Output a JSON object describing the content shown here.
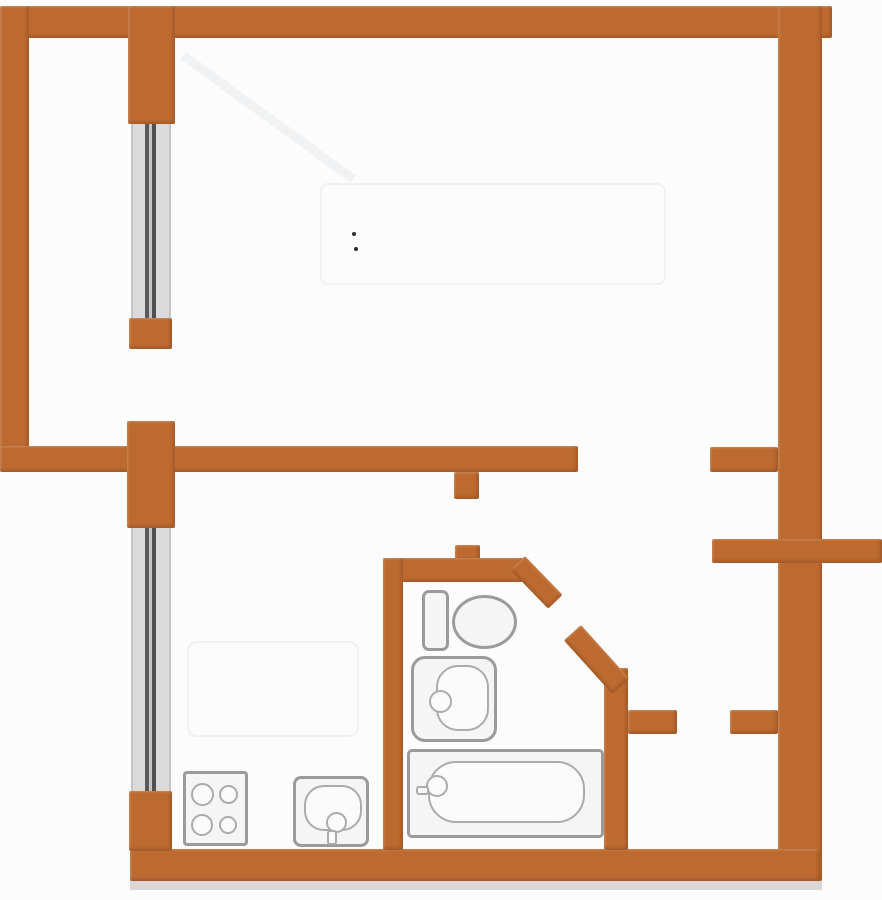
{
  "plan": {
    "name": "one-room-apartment-floor-plan",
    "canvas": {
      "width": 882,
      "height": 900
    }
  },
  "colors": {
    "bg": "#fcfcfc",
    "wall": "#bd6a30",
    "wallShade": "#8f4f1e",
    "glassFrame": "#c4c4c4",
    "glassDark": "#4f4f4f",
    "fixtureStroke": "#9b9b9b",
    "fixtureStrokeLight": "#ababab",
    "fixtureFill": "#f5f5f5",
    "shade": "#b7b1ab",
    "ghost": "#eef0f1"
  },
  "shapes": [
    {
      "name": "shadow-under-bottom-wall",
      "type": "rect",
      "x": 130,
      "y": 878,
      "w": 692,
      "h": 12,
      "cls": "shade"
    },
    {
      "name": "ghost-sunbeam",
      "type": "rect",
      "x": 186,
      "y": 52,
      "w": 210,
      "h": 9,
      "rot": 36,
      "cls": "ghost-line"
    },
    {
      "name": "ghost-bed",
      "type": "rect",
      "x": 320,
      "y": 183,
      "w": 346,
      "h": 102,
      "r": 8,
      "cls": "ghost"
    },
    {
      "name": "ghost-kitchen-table",
      "type": "rect",
      "x": 187,
      "y": 641,
      "w": 172,
      "h": 96,
      "r": 10,
      "cls": "ghost"
    },
    {
      "name": "ghost-mark-1",
      "type": "rect",
      "x": 352,
      "y": 232,
      "w": 4,
      "h": 4,
      "cls": "dot"
    },
    {
      "name": "ghost-mark-2",
      "type": "rect",
      "x": 354,
      "y": 247,
      "w": 4,
      "h": 4,
      "cls": "dot"
    },
    {
      "name": "balcony-window",
      "type": "window",
      "x": 131,
      "y": 120,
      "w": 40,
      "h": 202,
      "cls": "window"
    },
    {
      "name": "kitchen-window",
      "type": "window",
      "x": 131,
      "y": 527,
      "w": 40,
      "h": 266,
      "cls": "window"
    },
    {
      "name": "top-wall",
      "type": "rect",
      "x": 0,
      "y": 6,
      "w": 832,
      "h": 32,
      "cls": "wall"
    },
    {
      "name": "left-wall",
      "type": "rect",
      "x": 0,
      "y": 6,
      "w": 29,
      "h": 466,
      "cls": "wall"
    },
    {
      "name": "right-wall",
      "type": "rect",
      "x": 778,
      "y": 6,
      "w": 44,
      "h": 875,
      "cls": "wall"
    },
    {
      "name": "bottom-wall",
      "type": "rect",
      "x": 130,
      "y": 849,
      "w": 690,
      "h": 32,
      "cls": "wall"
    },
    {
      "name": "divider-wall",
      "type": "rect",
      "x": 0,
      "y": 446,
      "w": 578,
      "h": 26,
      "cls": "wall"
    },
    {
      "name": "window-pier-upper",
      "type": "rect",
      "x": 128,
      "y": 6,
      "w": 47,
      "h": 118,
      "cls": "wall"
    },
    {
      "name": "balcony-window-stub",
      "type": "rect",
      "x": 129,
      "y": 318,
      "w": 43,
      "h": 31,
      "cls": "wall"
    },
    {
      "name": "window-pier-middle",
      "type": "rect",
      "x": 127,
      "y": 421,
      "w": 48,
      "h": 107,
      "cls": "wall"
    },
    {
      "name": "kitchen-window-lower-wall",
      "type": "rect",
      "x": 129,
      "y": 791,
      "w": 43,
      "h": 60,
      "cls": "wall"
    },
    {
      "name": "kitchen-door-jamb-upper",
      "type": "rect",
      "x": 454,
      "y": 472,
      "w": 25,
      "h": 27,
      "cls": "wall"
    },
    {
      "name": "kitchen-door-jamb-lower",
      "type": "rect",
      "x": 455,
      "y": 545,
      "w": 25,
      "h": 16,
      "cls": "wall"
    },
    {
      "name": "bathroom-top-wall",
      "type": "rect",
      "x": 383,
      "y": 558,
      "w": 140,
      "h": 24,
      "cls": "wall"
    },
    {
      "name": "bathroom-left-wall",
      "type": "rect",
      "x": 383,
      "y": 558,
      "w": 20,
      "h": 292,
      "cls": "wall"
    },
    {
      "name": "bathroom-right-wall",
      "type": "rect",
      "x": 604,
      "y": 668,
      "w": 24,
      "h": 182,
      "cls": "wall"
    },
    {
      "name": "living-room-door-jamb",
      "type": "rect",
      "x": 710,
      "y": 447,
      "w": 68,
      "h": 25,
      "cls": "wall"
    },
    {
      "name": "landing-wall",
      "type": "rect",
      "x": 712,
      "y": 539,
      "w": 170,
      "h": 24,
      "cls": "wall"
    },
    {
      "name": "closet-jamb-left",
      "type": "rect",
      "x": 628,
      "y": 710,
      "w": 49,
      "h": 24,
      "cls": "wall"
    },
    {
      "name": "closet-jamb-right",
      "type": "rect",
      "x": 730,
      "y": 710,
      "w": 48,
      "h": 24,
      "cls": "wall"
    },
    {
      "name": "bathroom-door-jamb-diagonal",
      "type": "rect",
      "x": 525,
      "y": 556,
      "w": 54,
      "h": 20,
      "rot": 46,
      "cls": "wall"
    },
    {
      "name": "entry-door-diagonal",
      "type": "rect",
      "x": 581,
      "y": 625,
      "w": 72,
      "h": 23,
      "rot": 48,
      "cls": "wall"
    },
    {
      "name": "toilet-tank",
      "type": "rect",
      "x": 422,
      "y": 590,
      "w": 27,
      "h": 61,
      "r": 7,
      "cls": "fixture"
    },
    {
      "name": "toilet-bowl",
      "type": "ellipse",
      "x": 452,
      "y": 595,
      "w": 65,
      "h": 54,
      "cls": "fixture"
    },
    {
      "name": "washbasin",
      "type": "rect",
      "x": 411,
      "y": 656,
      "w": 86,
      "h": 86,
      "r": 14,
      "cls": "fixture"
    },
    {
      "name": "washbasin-bowl",
      "type": "rect",
      "x": 436,
      "y": 665,
      "w": 53,
      "h": 66,
      "r": 22,
      "cls": "fixture-thin"
    },
    {
      "name": "washbasin-drain",
      "type": "ellipse",
      "x": 429,
      "y": 690,
      "w": 23,
      "h": 23,
      "cls": "fixture-thin"
    },
    {
      "name": "bathtub",
      "type": "rect",
      "x": 407,
      "y": 749,
      "w": 197,
      "h": 89,
      "r": 5,
      "cls": "fixture"
    },
    {
      "name": "bathtub-basin",
      "type": "rect",
      "x": 428,
      "y": 761,
      "w": 157,
      "h": 62,
      "r": 28,
      "cls": "fixture-thin"
    },
    {
      "name": "bathtub-faucet",
      "type": "ellipse",
      "x": 426,
      "y": 775,
      "w": 22,
      "h": 22,
      "cls": "fixture-thin"
    },
    {
      "name": "bathtub-faucet-stem",
      "type": "rect",
      "x": 416,
      "y": 786,
      "w": 13,
      "h": 9,
      "r": 3,
      "cls": "fixture-thin"
    },
    {
      "name": "stove",
      "type": "rect",
      "x": 183,
      "y": 771,
      "w": 65,
      "h": 75,
      "r": 4,
      "cls": "fixture"
    },
    {
      "name": "stove-burner-1",
      "type": "ellipse",
      "x": 191,
      "y": 783,
      "w": 23,
      "h": 23,
      "cls": "fixture-thin"
    },
    {
      "name": "stove-burner-2",
      "type": "ellipse",
      "x": 219,
      "y": 785,
      "w": 19,
      "h": 19,
      "cls": "fixture-thin"
    },
    {
      "name": "stove-burner-3",
      "type": "ellipse",
      "x": 191,
      "y": 814,
      "w": 22,
      "h": 22,
      "cls": "fixture-thin"
    },
    {
      "name": "stove-burner-4",
      "type": "ellipse",
      "x": 219,
      "y": 816,
      "w": 18,
      "h": 18,
      "cls": "fixture-thin"
    },
    {
      "name": "kitchen-sink",
      "type": "rect",
      "x": 293,
      "y": 776,
      "w": 76,
      "h": 71,
      "r": 8,
      "cls": "fixture"
    },
    {
      "name": "kitchen-sink-bowl",
      "type": "rect",
      "x": 304,
      "y": 785,
      "w": 58,
      "h": 46,
      "r": 20,
      "cls": "fixture-thin"
    },
    {
      "name": "kitchen-sink-drain",
      "type": "ellipse",
      "x": 326,
      "y": 812,
      "w": 21,
      "h": 21,
      "cls": "fixture-thin"
    },
    {
      "name": "kitchen-sink-faucet",
      "type": "rect",
      "x": 327,
      "y": 830,
      "w": 10,
      "h": 15,
      "r": 3,
      "cls": "fixture-thin"
    }
  ],
  "rooms": [
    {
      "name": "room-balcony",
      "x": 29,
      "y": 38,
      "w": 99,
      "h": 408
    },
    {
      "name": "room-living",
      "x": 175,
      "y": 38,
      "w": 603,
      "h": 408
    },
    {
      "name": "room-kitchen",
      "x": 172,
      "y": 472,
      "w": 211,
      "h": 377
    },
    {
      "name": "room-bathroom",
      "x": 403,
      "y": 582,
      "w": 201,
      "h": 267
    },
    {
      "name": "room-hallway",
      "x": 479,
      "y": 472,
      "w": 299,
      "h": 377
    },
    {
      "name": "room-closet",
      "x": 628,
      "y": 734,
      "w": 150,
      "h": 115
    }
  ]
}
